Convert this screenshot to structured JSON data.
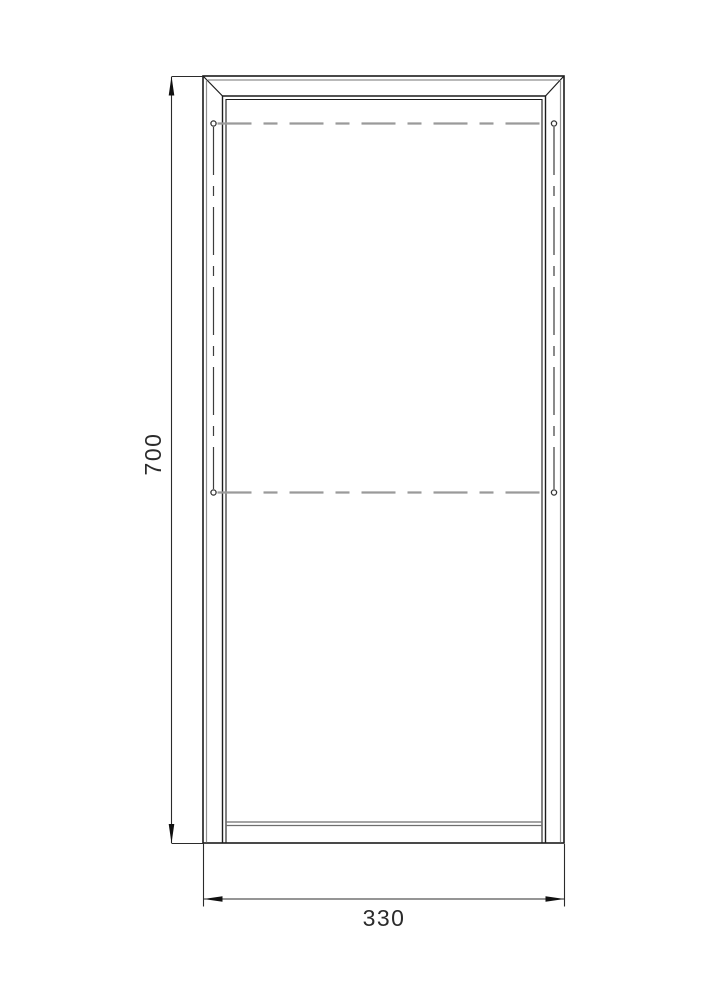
{
  "drawing": {
    "kind": "frame-elevation-technical-drawing",
    "background": "#ffffff",
    "colors": {
      "frame_line": "#1c1c1c",
      "secondary_line": "#8f8f8f",
      "centerline": "#9a9a9a",
      "axis_line": "#3d3d3d",
      "dimension_line": "#2b2b2b",
      "text": "#2b2b2b"
    },
    "dimensions": {
      "height": {
        "label": "700",
        "orientation": "vertical",
        "side": "left"
      },
      "width": {
        "label": "330",
        "orientation": "horizontal",
        "side": "bottom"
      }
    },
    "hinge_markers": {
      "rows": 2,
      "circles": 4,
      "style": "dashed-centerline-with-end-circles"
    }
  }
}
